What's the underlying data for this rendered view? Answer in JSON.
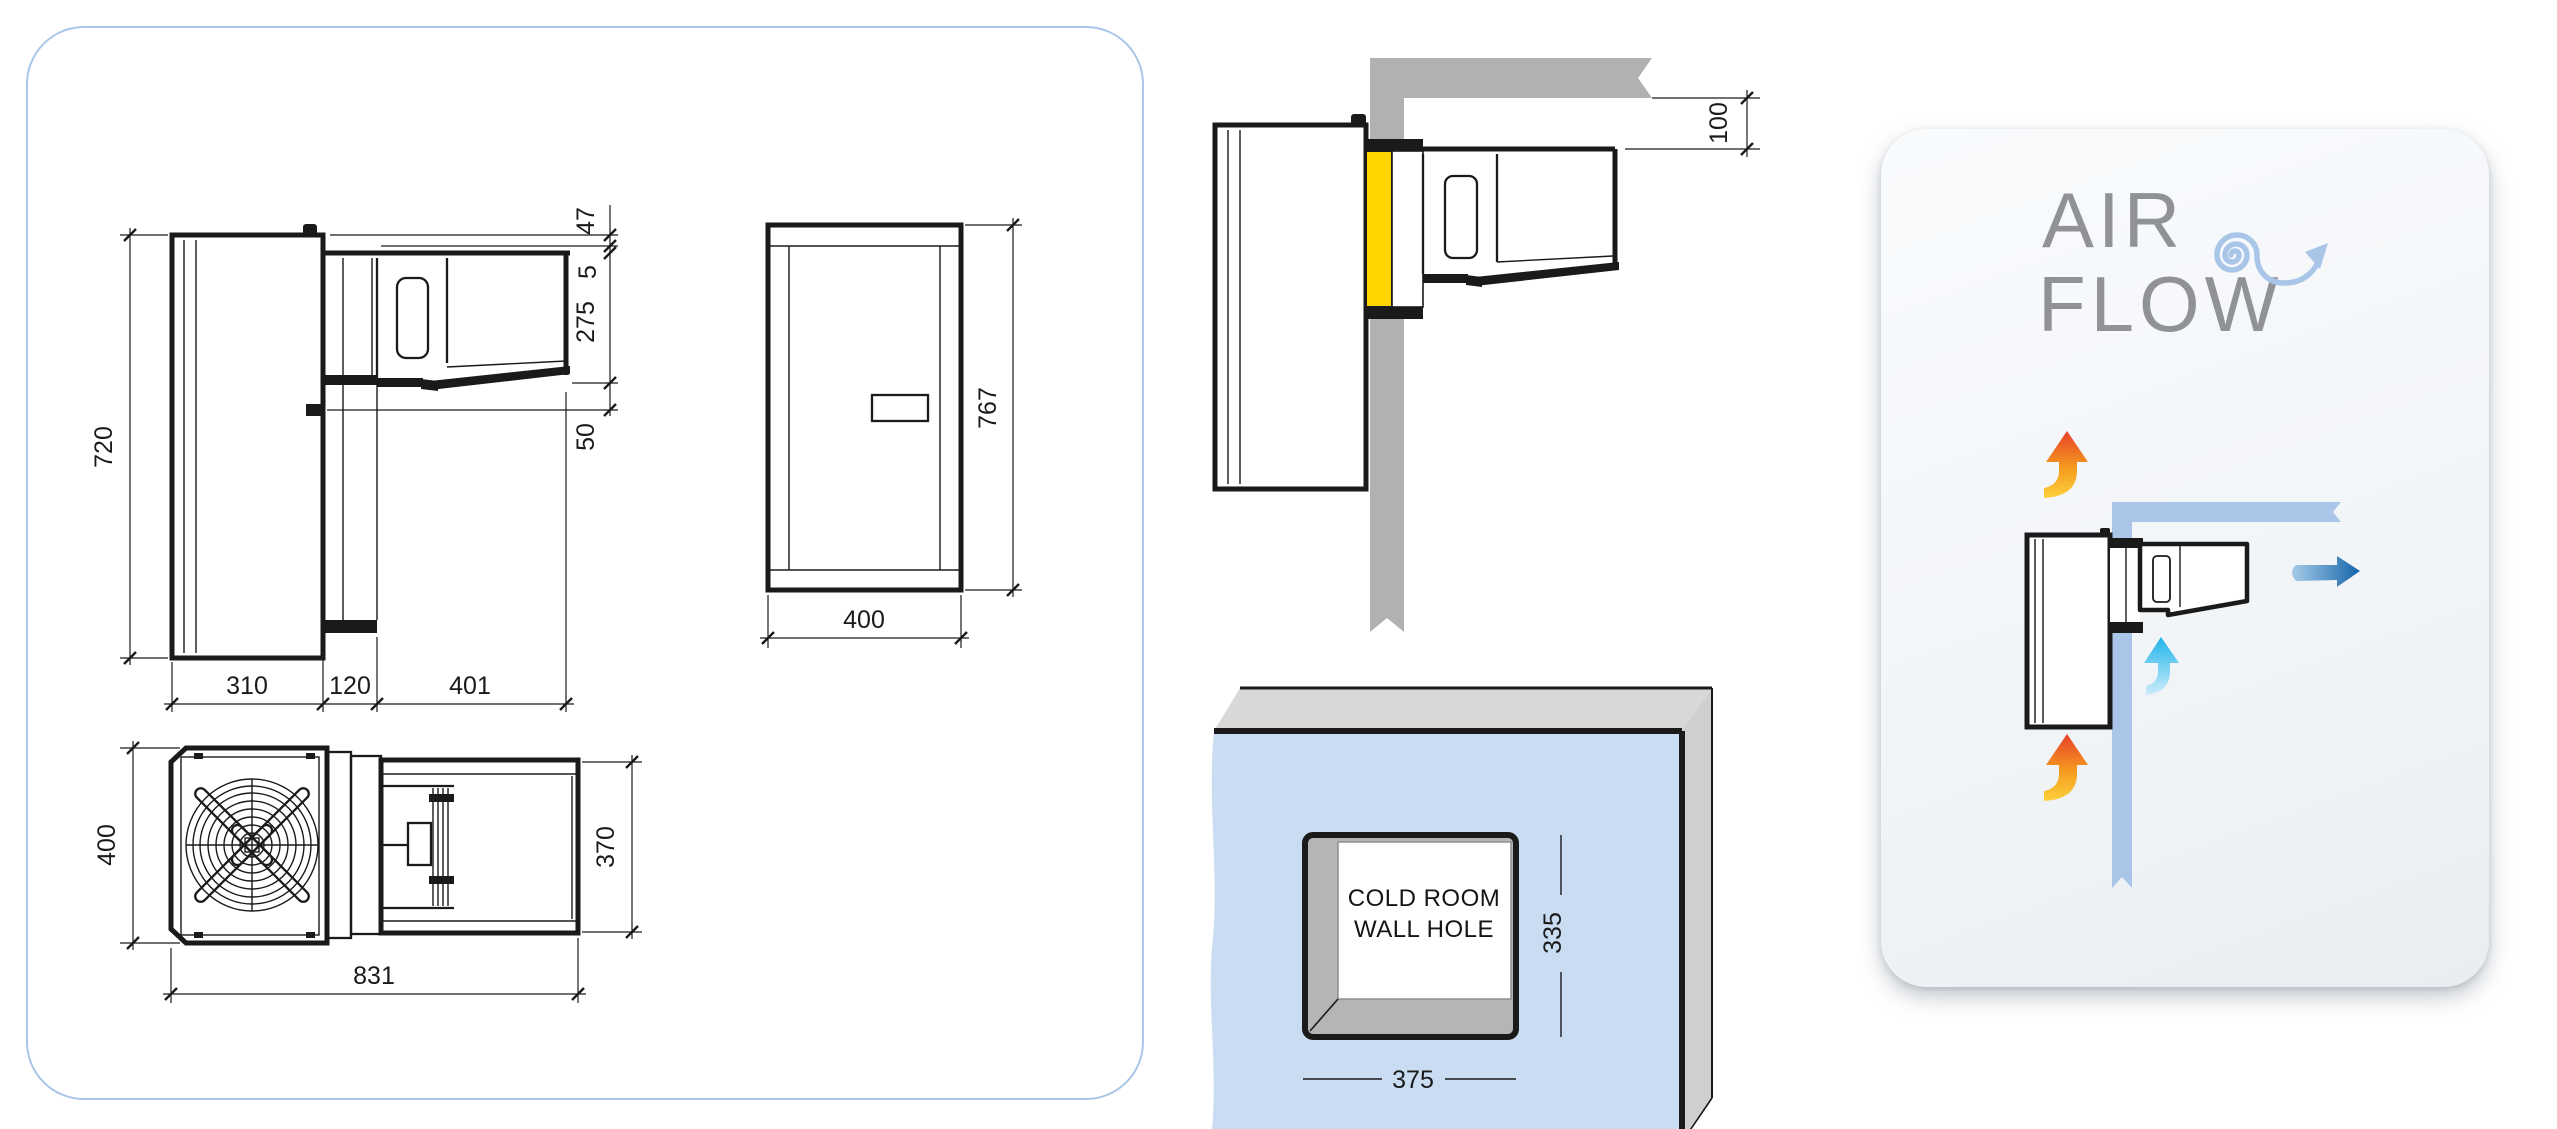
{
  "colors": {
    "ink": "#1a1a1a",
    "panel-border": "#a9c5e7",
    "band-blue": "#a9c6e8",
    "wall-blue": "#c9dcf2",
    "gray-wall": "#b1b1b1",
    "gray-top": "#d8d8d8",
    "gray-side": "#cfcfcf",
    "gray-bevel": "#b5b5b5",
    "yellow": "#ffd500",
    "text-gray": "#909295",
    "arrow-red": "#e8402a",
    "arrow-orange": "#f59b1e",
    "arrow-yellow": "#fdd03c",
    "arrow-cyan": "#1fb4e9",
    "arrow-cyan-pale": "#cdecfa",
    "arrow-blue": "#1465a9",
    "arrow-blue-pale": "#a6cbe9"
  },
  "side_view": {
    "dim_height": "720",
    "dim_depth_inner": "310",
    "dim_depth_mid": "120",
    "dim_depth_outer": "401",
    "dim_top_offset": "47",
    "dim_step": "5",
    "dim_unit_height": "275",
    "dim_bottom_gap": "50"
  },
  "front_view": {
    "dim_width": "400",
    "dim_height": "767"
  },
  "top_view": {
    "dim_width": "400",
    "dim_length": "831",
    "dim_condenser_width": "370"
  },
  "wall_section": {
    "dim_ceiling_clearance": "100"
  },
  "wall_hole": {
    "label_line1": "COLD ROOM",
    "label_line2": "WALL HOLE",
    "dim_width": "375",
    "dim_height": "335"
  },
  "airflow": {
    "title_line1": "AIR",
    "title_line2": "FLOW"
  },
  "icons": {
    "spiral": "air-swirl-arrow",
    "warm_air": "warm-air-up-arrow",
    "cold_air_in": "cold-air-up-arrow",
    "cold_air_out": "cold-air-right-arrow"
  }
}
